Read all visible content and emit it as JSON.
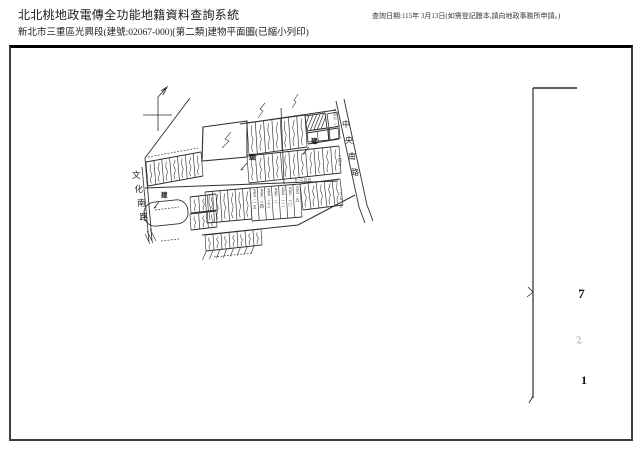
{
  "header": {
    "title": "北北桃地政電傳全功能地籍資料查詢系統",
    "subtitle": "新北市三重區光興段(建號:02067-000)[第二類]建物平面圖(已縮小列印)",
    "query_date_note": "查詢日期:115年 3月13日(如需登記謄本,請向地政事務所申請。)"
  },
  "plan": {
    "jian_label": "建",
    "roads": [
      {
        "name": "文化南路",
        "x": 132,
        "y": 178,
        "dy": 14,
        "dx": 2.5,
        "s": 8.5
      },
      {
        "name": "中央南路",
        "x": 342,
        "y": 127,
        "dy": 16,
        "dx": 3,
        "s": 8
      }
    ],
    "lot_labels_55": [
      "五五-一五",
      "五五-三四",
      "五五-三三",
      "五五-二",
      "五五-一二",
      "五五-一〇",
      "五五-五"
    ],
    "roadside_labels": [
      {
        "t": "三四七-二",
        "x": 335,
        "y": 112
      },
      {
        "t": "三四五-二",
        "x": 340,
        "y": 158
      },
      {
        "t": "二一五-五",
        "x": 341,
        "y": 192
      }
    ],
    "dim_label": {
      "t": "五-二五五",
      "x": 294,
      "y": 181
    },
    "margin_digits": [
      {
        "t": "7",
        "x": 578,
        "y": 298,
        "s": 13,
        "c": "#141414",
        "rot": 2
      },
      {
        "t": "2",
        "x": 577,
        "y": 344,
        "s": 11,
        "c": "#c3c3c3",
        "rot": -12
      },
      {
        "t": "1",
        "x": 581,
        "y": 384,
        "s": 12,
        "c": "#141414",
        "rot": 0
      }
    ],
    "north": {
      "lines": [
        [
          143,
          115,
          172,
          115,
          0.8
        ],
        [
          158,
          97,
          158,
          131,
          0.8
        ],
        [
          158,
          97,
          167,
          87,
          0.9
        ]
      ],
      "barb": [
        [
          161,
          91
        ],
        [
          167,
          87
        ],
        [
          163,
          95
        ]
      ]
    },
    "lines": [
      [
        240,
        124,
        336,
        110,
        1
      ],
      [
        145,
        188,
        338,
        181,
        1
      ],
      [
        281,
        108,
        284,
        184,
        0.8
      ],
      [
        307,
        130,
        313,
        115,
        0.7
      ],
      [
        310.5,
        130,
        316.5,
        115,
        0.7
      ],
      [
        314,
        129.5,
        320,
        114.5,
        0.7
      ],
      [
        317.5,
        129,
        323.5,
        114,
        0.7
      ],
      [
        321,
        129,
        326,
        116,
        0.7
      ],
      [
        305.5,
        125,
        309,
        116,
        0.7
      ],
      [
        147,
        231,
        153,
        243,
        0.6
      ],
      [
        150,
        229,
        156,
        241,
        0.6
      ],
      [
        145,
        234,
        150,
        244,
        0.6
      ],
      [
        533,
        88,
        533,
        398,
        1.2
      ],
      [
        533,
        88,
        577,
        88,
        1.5
      ],
      [
        533,
        396,
        529,
        403,
        0.9
      ]
    ],
    "dashed": [
      [
        148,
        157,
        198,
        148
      ],
      [
        214,
        257,
        252,
        253
      ],
      [
        161,
        241,
        179,
        239
      ],
      [
        155,
        210,
        179,
        207
      ]
    ],
    "polylines": [
      {
        "p": [
          [
            203,
            127
          ],
          [
            247,
            121
          ],
          [
            247,
            157
          ],
          [
            202,
            161
          ]
        ],
        "w": 1.1,
        "close": true
      },
      {
        "p": [
          [
            202,
            235
          ],
          [
            298,
            225
          ],
          [
            355,
            195
          ]
        ],
        "w": 1
      },
      {
        "p": [
          [
            190,
            98
          ],
          [
            145,
            158
          ],
          [
            152,
            241
          ]
        ],
        "w": 0.9
      },
      {
        "p": [
          [
            142,
            167
          ],
          [
            149,
            242
          ]
        ],
        "w": 0.8
      },
      {
        "p": [
          [
            336,
            101
          ],
          [
            359,
            207
          ],
          [
            365,
            223
          ]
        ],
        "w": 0.9
      },
      {
        "p": [
          [
            344,
            99
          ],
          [
            367,
            205
          ],
          [
            373,
            221
          ]
        ],
        "w": 0.9
      },
      {
        "p": [
          [
            305,
            116
          ],
          [
            325,
            113
          ],
          [
            327,
            128
          ],
          [
            307,
            131
          ]
        ],
        "w": 0.9,
        "close": true
      },
      {
        "p": [
          [
            307,
            131
          ],
          [
            328,
            128
          ],
          [
            329,
            140
          ],
          [
            308,
            142
          ]
        ],
        "w": 0.8,
        "close": true
      },
      {
        "p": [
          [
            327,
            114
          ],
          [
            337,
            112
          ],
          [
            339,
            126
          ],
          [
            329,
            128
          ]
        ],
        "w": 0.8,
        "close": true
      },
      {
        "p": [
          [
            329,
            128
          ],
          [
            339,
            126
          ],
          [
            340,
            138
          ],
          [
            330,
            140
          ]
        ],
        "w": 0.8,
        "close": true
      },
      {
        "p": [
          [
            258,
            118
          ],
          [
            263,
            111
          ],
          [
            260,
            109
          ],
          [
            265,
            103
          ]
        ],
        "w": 0.6
      },
      {
        "p": [
          [
            292,
            108
          ],
          [
            296,
            102
          ],
          [
            294,
            100
          ],
          [
            298,
            94
          ]
        ],
        "w": 0.6
      },
      {
        "p": [
          [
            231,
            132
          ],
          [
            225,
            139
          ],
          [
            229,
            141
          ],
          [
            222,
            148
          ]
        ],
        "w": 0.6
      },
      {
        "p": [
          [
            527,
            297
          ],
          [
            533,
            292
          ],
          [
            528,
            287
          ]
        ],
        "w": 0.8
      }
    ],
    "bands": [
      {
        "t": [
          146,
          162,
          201,
          152
        ],
        "len": 24,
        "dx": 2,
        "n": 7,
        "sq": true
      },
      {
        "t": [
          247,
          123,
          305,
          115
        ],
        "len": 32,
        "dx": 2,
        "n": 7,
        "sq": true
      },
      {
        "t": [
          307,
          133,
          338,
          128
        ],
        "len": 11,
        "dx": 1,
        "n": 3,
        "sq": false
      },
      {
        "t": [
          247,
          156,
          339,
          146
        ],
        "len": 27,
        "dx": 2,
        "n": 11,
        "sq": true
      },
      {
        "t": [
          205,
          192,
          250,
          188
        ],
        "len": 31,
        "dx": 2,
        "n": 6,
        "sq": true
      },
      {
        "t": [
          250,
          188,
          300,
          184
        ],
        "len": 33,
        "dx": 2,
        "n": 7,
        "sq": false,
        "labels": "lot_labels_55"
      },
      {
        "t": [
          300,
          184,
          340,
          179
        ],
        "len": 26,
        "dx": 3,
        "n": 5,
        "sq": true
      },
      {
        "t": [
          190,
          197,
          216,
          194
        ],
        "len": 16,
        "dx": 1,
        "n": 3,
        "sq": true
      },
      {
        "t": [
          190,
          214,
          216,
          211
        ],
        "len": 16,
        "dx": 1,
        "n": 3,
        "sq": true
      },
      {
        "t": [
          205,
          235,
          261,
          229
        ],
        "len": 16,
        "dx": 1,
        "n": 7,
        "sq": true
      }
    ],
    "fan": {
      "n": 8,
      "x0": 206,
      "y0": 251.5,
      "stepx": 6.9,
      "stepy": -0.85,
      "ddx": -3.5,
      "ddy": 8.5
    },
    "jian_marks": [
      {
        "x": 311,
        "y": 143,
        "a": [
          [
            309,
            147
          ],
          [
            303,
            154
          ]
        ]
      },
      {
        "x": 249,
        "y": 159,
        "a": [
          [
            247,
            163
          ],
          [
            241,
            170
          ]
        ]
      },
      {
        "x": 161,
        "y": 197,
        "a": [
          [
            159,
            202
          ],
          [
            154,
            208
          ]
        ]
      }
    ],
    "blob": {
      "x": 144,
      "y": 201,
      "w": 44,
      "h": 24,
      "rx": 11,
      "rot": -6,
      "cx": 166,
      "cy": 213
    }
  }
}
